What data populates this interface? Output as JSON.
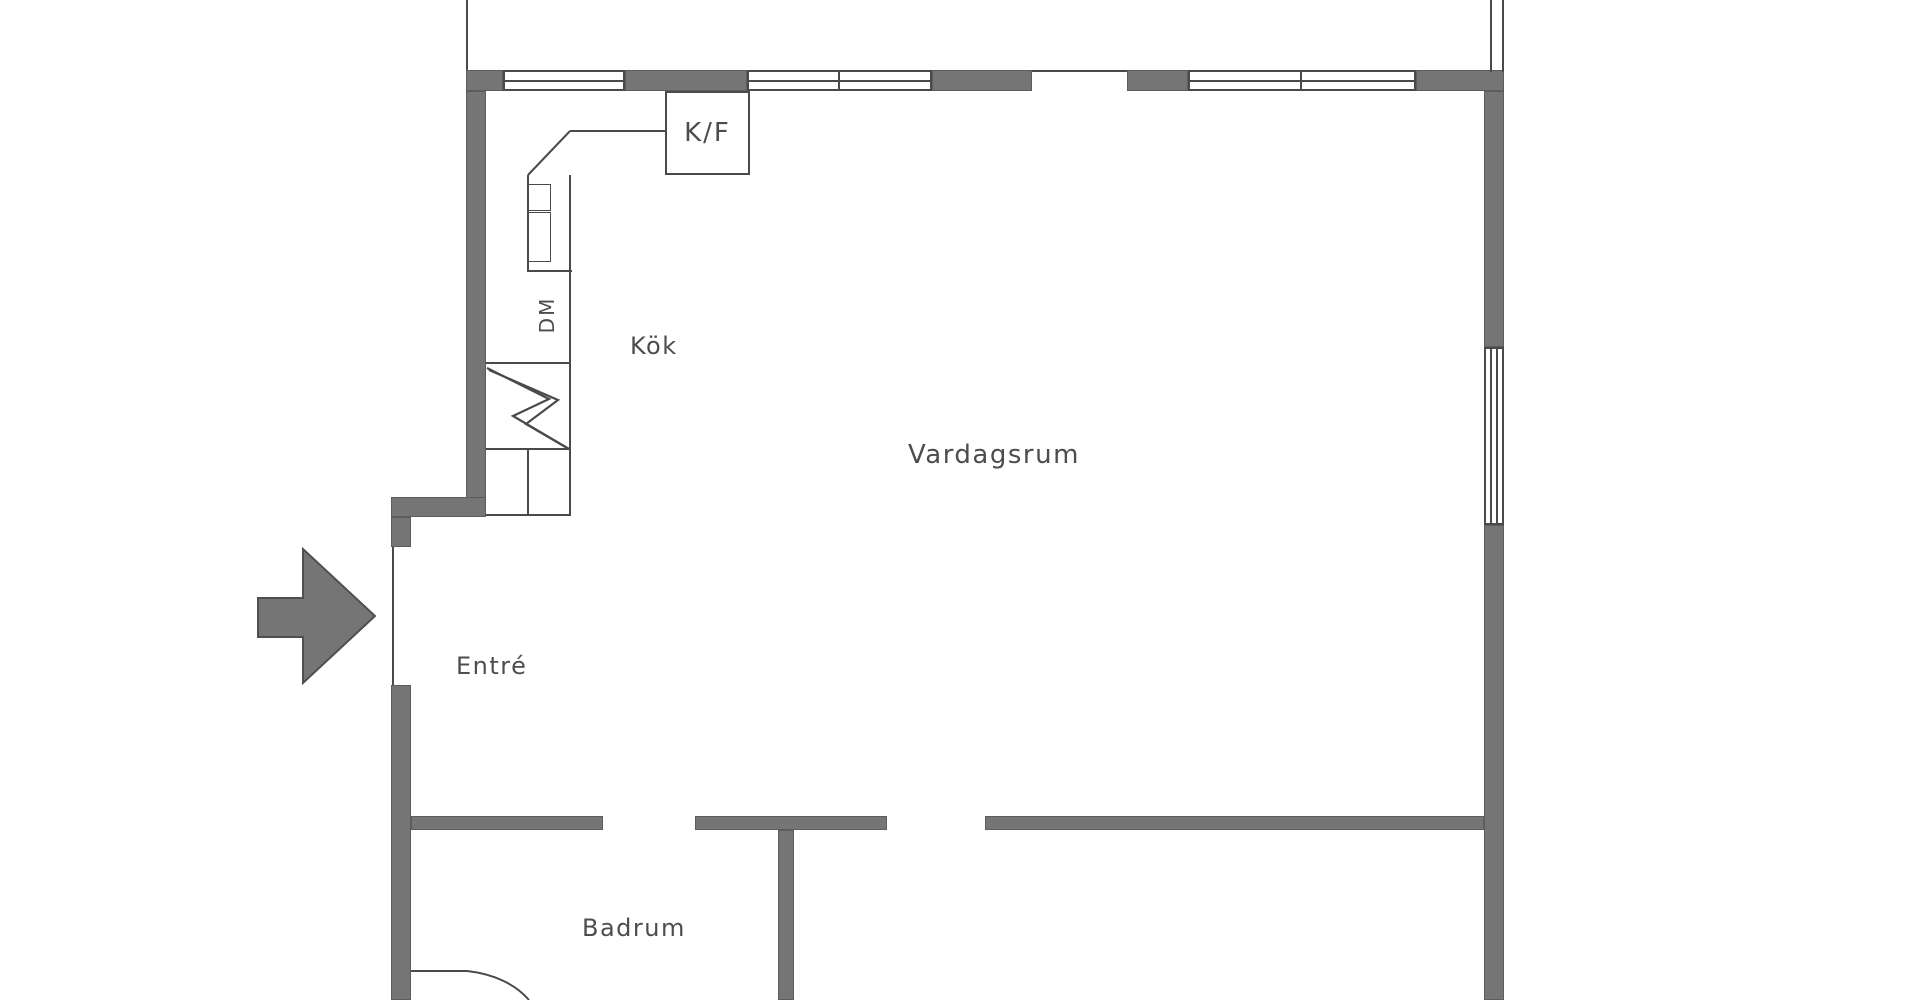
{
  "floorplan": {
    "rooms": [
      {
        "id": "kok",
        "label": "Kök"
      },
      {
        "id": "vardagsrum",
        "label": "Vardagsrum"
      },
      {
        "id": "entre",
        "label": "Entré"
      },
      {
        "id": "badrum",
        "label": "Badrum"
      }
    ],
    "appliances": [
      {
        "id": "kf",
        "label": "K/F"
      },
      {
        "id": "dm",
        "label": "DM"
      }
    ],
    "entrance": {
      "symbol": "arrow-right"
    },
    "colors": {
      "wall": "#757575",
      "line": "#4a4a4a",
      "text": "#4d4d4d",
      "bg": "#ffffff"
    }
  }
}
